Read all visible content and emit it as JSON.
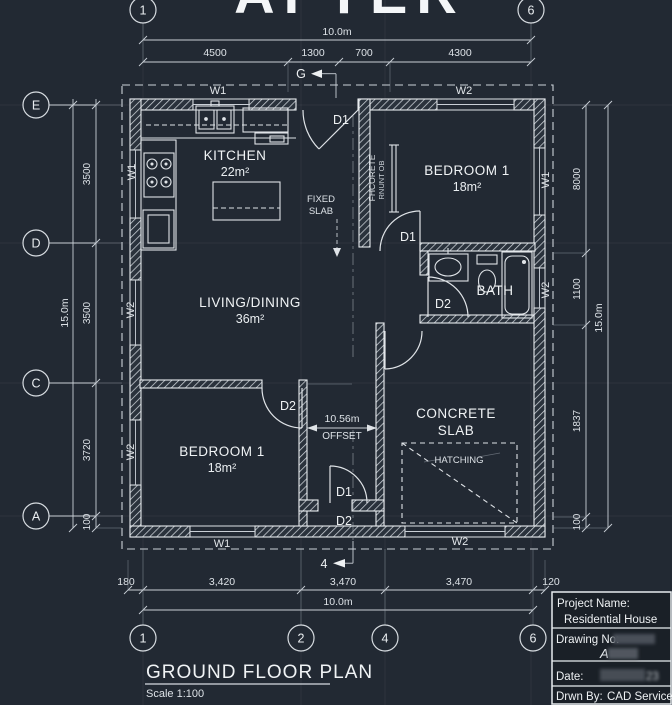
{
  "title": "AFTER",
  "plan_title": "GROUND FLOOR PLAN",
  "plan_scale": "Scale 1:100",
  "grid_bubbles": {
    "top": [
      "1",
      "6"
    ],
    "left": [
      "E",
      "D",
      "C",
      "A"
    ],
    "bottom": [
      "1",
      "2",
      "4",
      "6"
    ]
  },
  "rooms": {
    "kitchen": {
      "name": "KITCHEN",
      "area": "22m²"
    },
    "bedroom_tr": {
      "name": "BEDROOM 1",
      "area": "18m²"
    },
    "living": {
      "name": "LIVING/DINING",
      "area": "36m²"
    },
    "bath": {
      "name": "BATH"
    },
    "bedroom_bl": {
      "name": "BEDROOM 1",
      "area": "18m²"
    },
    "concrete": {
      "line1": "CONCRETE",
      "line2": "SLAB"
    }
  },
  "dims": {
    "top_total": "10.0m",
    "top_segments": [
      "4500",
      "1300",
      "700",
      "4300"
    ],
    "bottom_segments": [
      "180",
      "3,420",
      "3,470",
      "3,470",
      "120"
    ],
    "bottom_total": "10.0m",
    "left_total": "15.0m",
    "left_segments": [
      "3500",
      "3500",
      "3720",
      "100"
    ],
    "right_segments": [
      "8000",
      "1100",
      "1837",
      "100"
    ],
    "right_total": "15.0m",
    "offset_value": "10.56m",
    "offset_label": "OFFSET"
  },
  "walls": {
    "w1": "W1",
    "w2": "W2"
  },
  "doors": {
    "d1": "D1",
    "d2": "D2"
  },
  "annotations": {
    "fixed_line1": "FIXED",
    "fixed_line2": "SLAB",
    "hatching": "HATCHING",
    "closet_line1": "FHCORETE",
    "closet_line2": "RNUNT OB",
    "section_top": "G",
    "section_bottom": "4"
  },
  "title_block": {
    "project_label": "Project Name:",
    "project_value": "Residential House",
    "drawing_label": "Drawing No:",
    "drawing_value": "A",
    "date_label": "Date:",
    "date_value": "23",
    "drawn_label": "Drwn By:",
    "drawn_value": "CAD Service"
  },
  "colors": {
    "background": "#222933",
    "line": "#d7dce1",
    "text": "#eef1f3"
  }
}
